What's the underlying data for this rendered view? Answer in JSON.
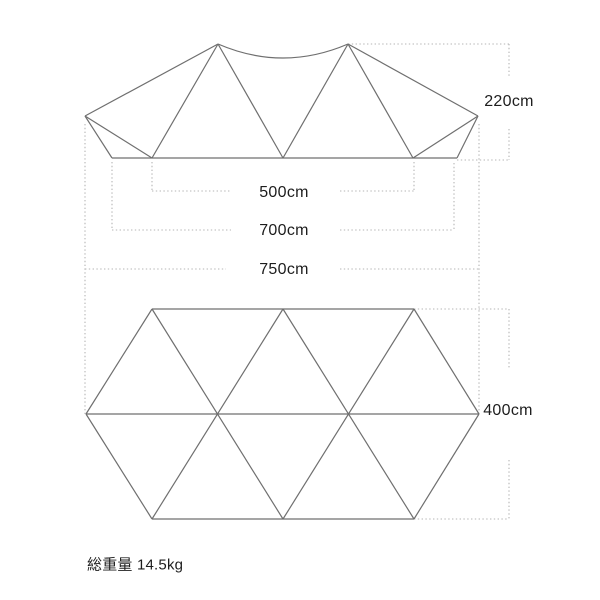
{
  "page": {
    "background": "#ffffff"
  },
  "colors": {
    "solid_line": "#6f6f6f",
    "dotted_line": "#b4b4b4",
    "label_text": "#1d1d1d"
  },
  "labels": {
    "height": "220cm",
    "ridge_width": "500cm",
    "body_width": "700cm",
    "total_width": "750cm",
    "depth": "400cm",
    "total_weight": "総重量 14.5kg"
  },
  "diagram": {
    "side_view": {
      "description": "tent front elevation with two peaks and sagging ridge",
      "solid_lines": [
        [
          85,
          116,
          218,
          44
        ],
        [
          348,
          44,
          478,
          116
        ],
        [
          85,
          116,
          112,
          158
        ],
        [
          85,
          116,
          152,
          158
        ],
        [
          218,
          44,
          152,
          158
        ],
        [
          218,
          44,
          283,
          158
        ],
        [
          348,
          44,
          283,
          158
        ],
        [
          348,
          44,
          413,
          158
        ],
        [
          478,
          116,
          413,
          158
        ],
        [
          478,
          116,
          457,
          158
        ],
        [
          112,
          158,
          457,
          158
        ]
      ],
      "ridge_curve": "M 218 44 Q 283 72 348 44"
    },
    "floor_plan": {
      "description": "elongated hexagon footprint built from triangles",
      "solid_lines": [
        [
          86,
          414,
          152,
          309
        ],
        [
          152,
          309,
          414,
          309
        ],
        [
          414,
          309,
          479,
          414
        ],
        [
          479,
          414,
          414,
          519
        ],
        [
          414,
          519,
          152,
          519
        ],
        [
          152,
          519,
          86,
          414
        ],
        [
          86,
          414,
          479,
          414
        ],
        [
          152,
          309,
          283,
          519
        ],
        [
          283,
          309,
          414,
          519
        ],
        [
          283,
          309,
          152,
          519
        ],
        [
          414,
          309,
          283,
          519
        ]
      ]
    },
    "dimension_guides": {
      "dotted_lines": [
        [
          348,
          44,
          509,
          44
        ],
        [
          509,
          44,
          509,
          76
        ],
        [
          509,
          129,
          509,
          160
        ],
        [
          457,
          160,
          509,
          160
        ],
        [
          152,
          162,
          152,
          191
        ],
        [
          414,
          162,
          414,
          191
        ],
        [
          152,
          191,
          231,
          191
        ],
        [
          340,
          191,
          414,
          191
        ],
        [
          112,
          162,
          112,
          230
        ],
        [
          454,
          163,
          454,
          230
        ],
        [
          112,
          230,
          231,
          230
        ],
        [
          340,
          230,
          454,
          230
        ],
        [
          85,
          124,
          85,
          414
        ],
        [
          479,
          124,
          479,
          414
        ],
        [
          85,
          269,
          226,
          269
        ],
        [
          340,
          269,
          479,
          269
        ],
        [
          414,
          309,
          509,
          309
        ],
        [
          509,
          309,
          509,
          368
        ],
        [
          509,
          460,
          509,
          519
        ],
        [
          414,
          519,
          509,
          519
        ]
      ]
    }
  }
}
